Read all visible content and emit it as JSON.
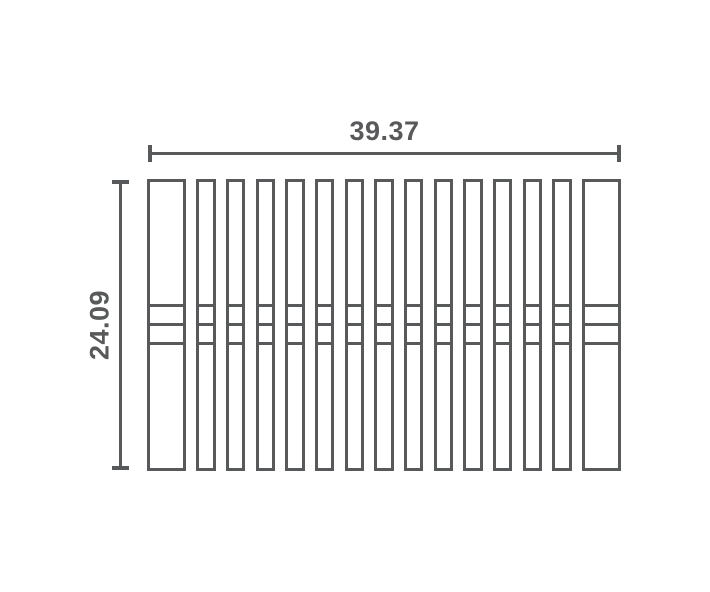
{
  "diagram": {
    "type": "dimensioned-technical-drawing",
    "subject": "slatted panel / rack top view with fifteen vertical slats and three horizontal crossbars",
    "width_dimension": {
      "label": "39.37"
    },
    "height_dimension": {
      "label": "24.09"
    },
    "slat_count": 15,
    "wide_slats": "first and last",
    "crossbar_count": 3,
    "stroke_color": "#58595b",
    "background_color": "#ffffff"
  }
}
